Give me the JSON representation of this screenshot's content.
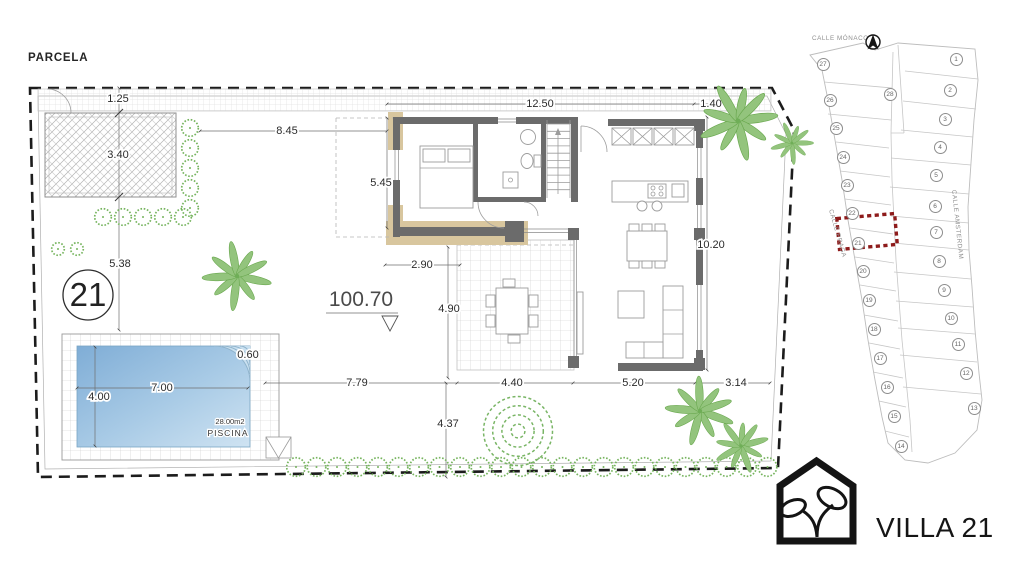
{
  "plan": {
    "title": "PARCELA",
    "plot_circle": "21",
    "level_marker": "100.70",
    "pool": {
      "corner": "0.60",
      "width": "7.00",
      "height": "4.00",
      "area": "28.00m2",
      "label": "PISCINA"
    },
    "dims": {
      "strip": "1.25",
      "driveway": "3.40",
      "left_mid": "5.38",
      "top_left": "8.45",
      "top_main": "12.50",
      "top_right": "1.40",
      "house_left": "5.45",
      "porch": "2.90",
      "terrace_height": "4.90",
      "house_right": "10.20",
      "bottom_pool_to_terrace": "7.79",
      "bottom_terrace": "4.40",
      "bottom_living": "5.20",
      "bottom_right": "3.14",
      "bottom_garden": "4.37"
    }
  },
  "sitemap": {
    "street_top": "CALLE MÓNACO",
    "street_left": "CALLE PRAGA",
    "street_right": "CALLE AMSTERDAM",
    "highlighted_plot": "21",
    "plots": [
      {
        "n": "27",
        "x": 28,
        "y": 49
      },
      {
        "n": "26",
        "x": 35,
        "y": 85
      },
      {
        "n": "25",
        "x": 41,
        "y": 113
      },
      {
        "n": "24",
        "x": 48,
        "y": 142
      },
      {
        "n": "23",
        "x": 52,
        "y": 170
      },
      {
        "n": "22",
        "x": 57,
        "y": 198
      },
      {
        "n": "21",
        "x": 63,
        "y": 228
      },
      {
        "n": "20",
        "x": 68,
        "y": 256
      },
      {
        "n": "19",
        "x": 74,
        "y": 285
      },
      {
        "n": "18",
        "x": 79,
        "y": 314
      },
      {
        "n": "17",
        "x": 85,
        "y": 343
      },
      {
        "n": "16",
        "x": 92,
        "y": 372
      },
      {
        "n": "15",
        "x": 99,
        "y": 401
      },
      {
        "n": "14",
        "x": 106,
        "y": 431
      },
      {
        "n": "28",
        "x": 95,
        "y": 79
      },
      {
        "n": "1",
        "x": 161,
        "y": 44
      },
      {
        "n": "2",
        "x": 155,
        "y": 75
      },
      {
        "n": "3",
        "x": 150,
        "y": 104
      },
      {
        "n": "4",
        "x": 145,
        "y": 132
      },
      {
        "n": "5",
        "x": 141,
        "y": 160
      },
      {
        "n": "6",
        "x": 140,
        "y": 191
      },
      {
        "n": "7",
        "x": 141,
        "y": 217
      },
      {
        "n": "8",
        "x": 144,
        "y": 246
      },
      {
        "n": "9",
        "x": 149,
        "y": 275
      },
      {
        "n": "10",
        "x": 156,
        "y": 303
      },
      {
        "n": "11",
        "x": 163,
        "y": 329
      },
      {
        "n": "12",
        "x": 171,
        "y": 358
      },
      {
        "n": "13",
        "x": 179,
        "y": 393
      }
    ]
  },
  "logo": {
    "label": "VILLA 21"
  },
  "colors": {
    "highlight_red": "#8e1b1b",
    "pool_blue": "#85b1d8",
    "plant_green": "#76b45e",
    "wall_gray": "#6b6b6b",
    "accent_tan": "#d8c69e"
  }
}
